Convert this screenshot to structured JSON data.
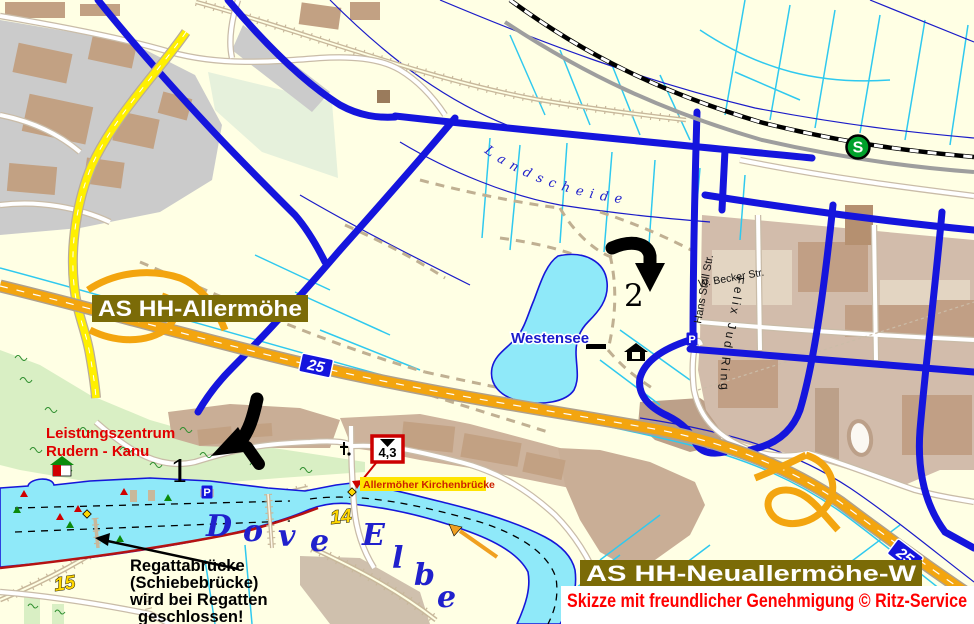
{
  "title": "Allermöhe area sketch map",
  "colors": {
    "background": "#FFFFE4",
    "road_blue": "#1515DD",
    "motorway_orange": "#F3A50F",
    "minor_water_cyan": "#2FC9EF",
    "water_fill": "#8FE9F9",
    "water_border": "#1616D9",
    "label_plate_olive": "#7B6B07",
    "credit_red": "#FF0000",
    "sbahn_green": "#00A12B",
    "km_marker_yellow": "#FFD700",
    "highlight_yellow": "#FFE400",
    "warning_red": "#CC0000",
    "urban_gray": "#CBCBCB",
    "building_tan": "#C2A183"
  },
  "labels": {
    "junction_west": "AS HH-Allermöhe",
    "junction_east": "AS HH-Neuallermöhe-W",
    "credit": "Skizze mit freundlicher Genehmigung © Ritz-Service",
    "lake": "Westensee",
    "stream": "Landscheide",
    "river_word1": "Dove",
    "river_word2": "Elbe",
    "street_hans_stoll": "Hans Stoll Str.",
    "street_becker": "W. Becker Str.",
    "street_felix_jud": "Felix Jud Ring",
    "training_center_line1": "Leistungszentrum",
    "training_center_line2": "Rudern - Kanu",
    "bridge_label": "Allermöher Kirchenbrücke",
    "note_line1": "Regattabrücke",
    "note_line2": "(Schiebebrücke)",
    "note_line3": "wird bei Regatten",
    "note_line4": "geschlossen!"
  },
  "markers": {
    "route_point_1": "1",
    "route_point_2": "2",
    "km_14": "14",
    "km_15": "15",
    "clearance": "4,3",
    "motorway_number": "25",
    "sbahn_letter": "S",
    "parking_letter": "P"
  }
}
